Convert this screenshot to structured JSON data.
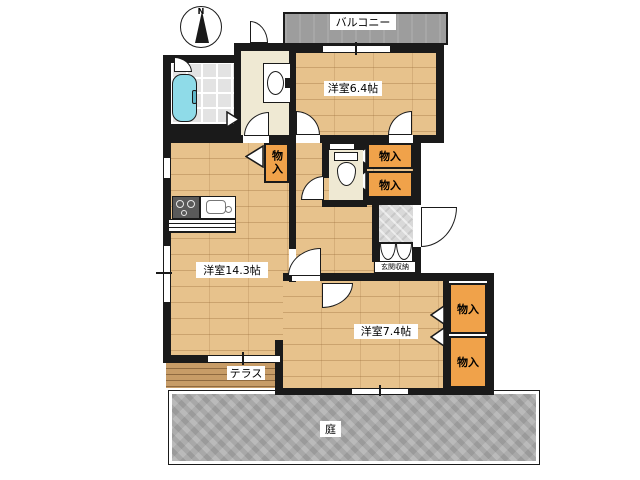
{
  "labels": {
    "compass_north": "N",
    "balcony": "バルコニー",
    "room_6_4": "洋室6.4帖",
    "room_14_3": "洋室14.3帖",
    "room_7_4": "洋室7.4帖",
    "storage": "物入",
    "entrance_storage": "玄関収納",
    "terrace": "テラス",
    "garden": "庭"
  },
  "colors": {
    "wall": "#1a1a1a",
    "wood_floor": "#e7c28c",
    "service_floor_beige": "#efe9d3",
    "closet_orange": "#f0a24a",
    "balcony_gray": "#9d9d9d",
    "garden_gray": "#adadad",
    "terrace_brown": "#c79c67",
    "bathtub_cyan": "#8fdbe8",
    "background": "#ffffff"
  }
}
